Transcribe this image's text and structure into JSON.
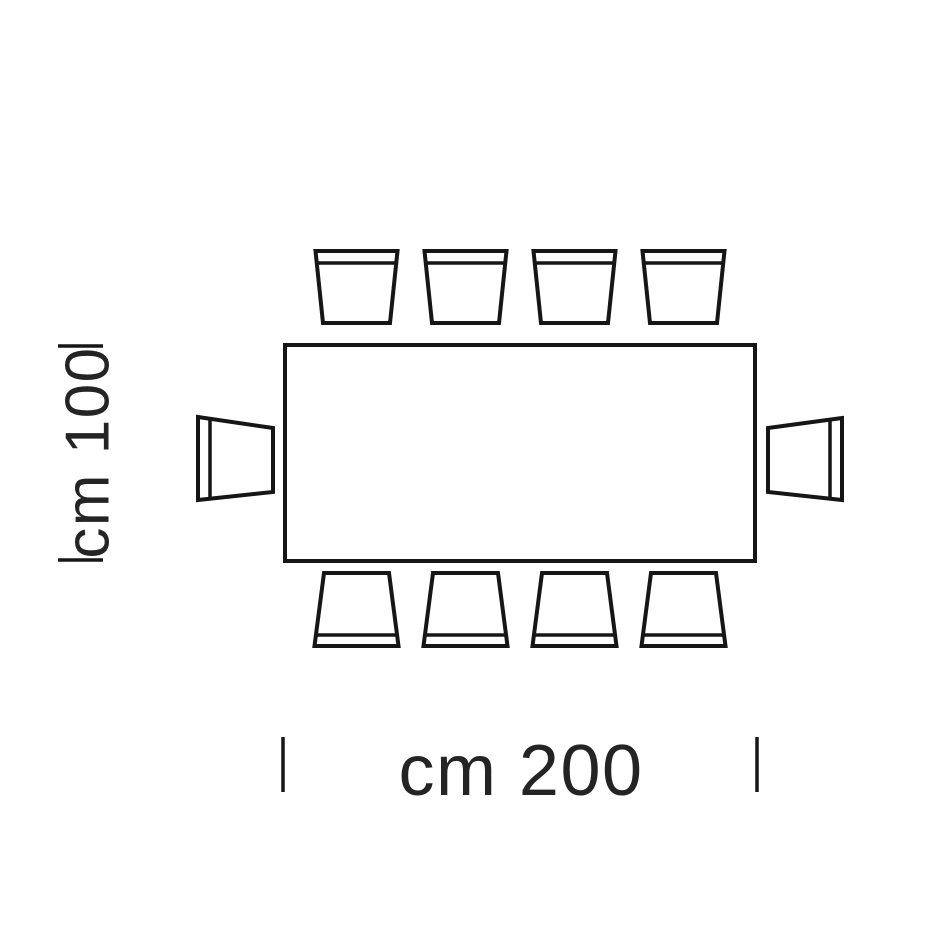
{
  "diagram": {
    "type": "furniture-top-view-dimension-diagram",
    "subject": "rectangular table with ten chairs, plan view",
    "dimensions": {
      "width_label": "cm 200",
      "height_label": "cm 100"
    },
    "furniture": {
      "table_shape": "rectangle",
      "chairs_total": 10,
      "chairs_top_row": 4,
      "chairs_bottom_row": 4,
      "chairs_left_side": 1,
      "chairs_right_side": 1
    },
    "colors": {
      "line": "#161616",
      "text": "#242424",
      "background": "#ffffff"
    }
  }
}
